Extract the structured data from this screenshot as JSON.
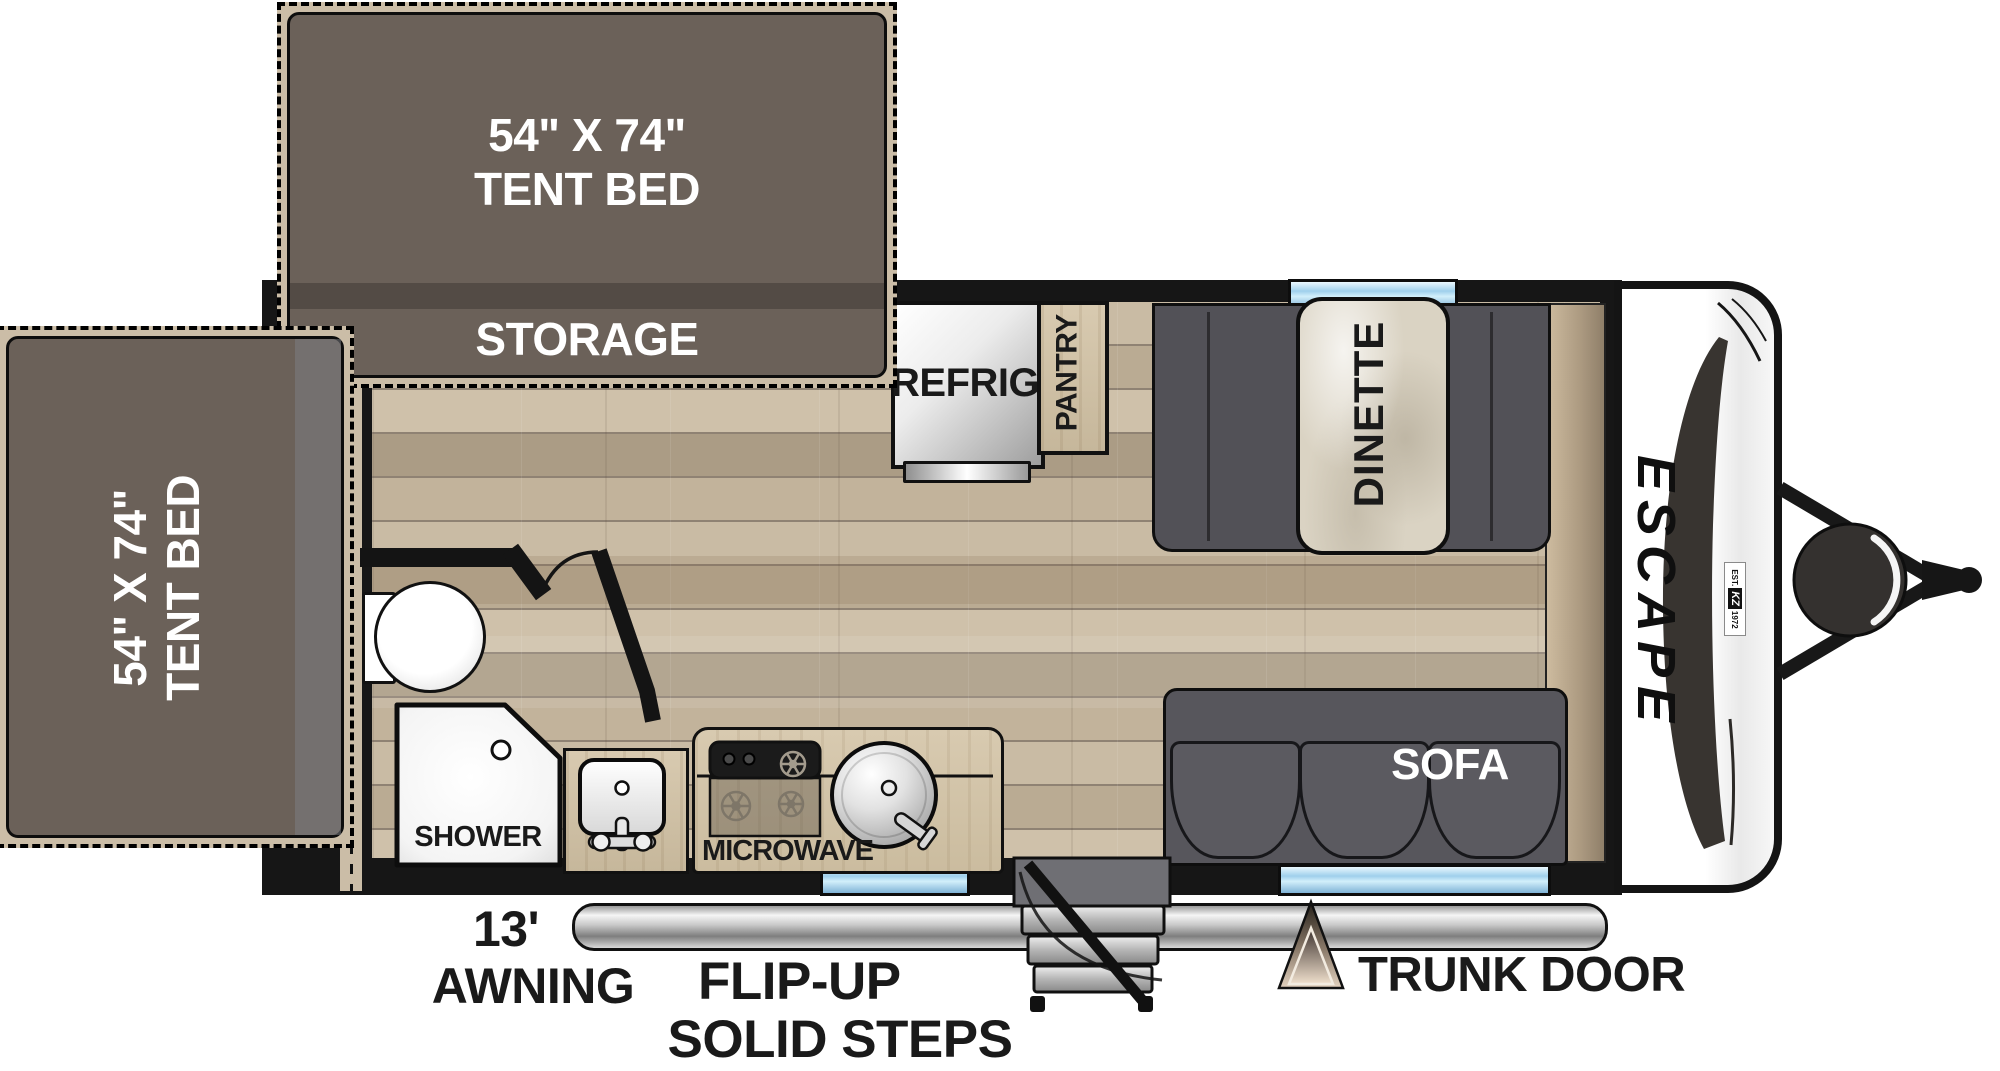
{
  "beds": {
    "top": {
      "line1": "54\" X 74\"",
      "line2": "TENT BED"
    },
    "left": {
      "line1": "54\" X 74\"",
      "line2": "TENT BED"
    }
  },
  "rooms": {
    "storage": "STORAGE",
    "refrig": "REFRIG",
    "pantry": "PANTRY",
    "dinette": "DINETTE",
    "sofa": "SOFA",
    "shower": "SHOWER",
    "microwave": "MICROWAVE"
  },
  "exterior": {
    "awning_length": "13'",
    "awning_label": "AWNING",
    "steps_line1": "FLIP-UP",
    "steps_line2": "SOLID STEPS",
    "trunk_door": "TRUNK DOOR"
  },
  "brand": {
    "name": "ESCAPE",
    "badge_est": "EST.",
    "badge_kz": "KZ",
    "badge_year": "1972"
  },
  "colors": {
    "bed_fill": "#6b6159",
    "bed_trim": "#cbbda7",
    "wall": "#161616",
    "bench_gray": "#55545a",
    "window_blue": "#8cc2e2",
    "floor_wood": "#c3b49c",
    "counter_wood": "#d5c7ac",
    "awning_silver": "#c9c9c9"
  }
}
